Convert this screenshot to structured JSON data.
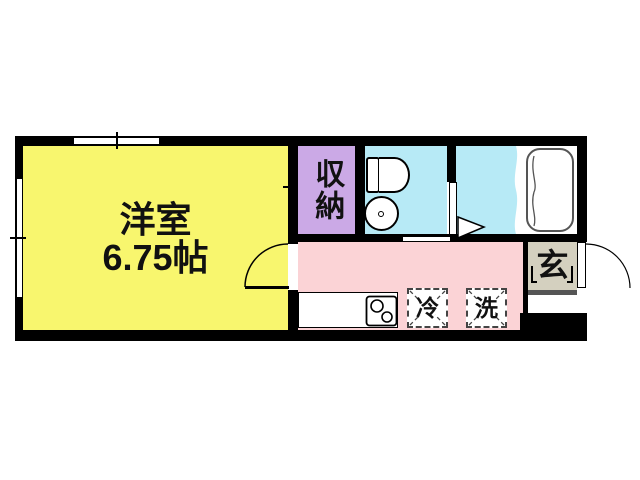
{
  "meta": {
    "type": "apartment-floor-plan"
  },
  "palette": {
    "wall": "#000000",
    "western_room": "#f8f66e",
    "closet": "#cba9e6",
    "wet_area": "#b7eaf6",
    "corridor": "#fbd3d6",
    "entrance": "#d4d0bf",
    "fixture_outline": "#555555"
  },
  "labels": {
    "western_room_name": "洋室",
    "western_room_size": "6.75帖",
    "closet": "収納",
    "refrigerator": "冷",
    "washing_machine": "洗",
    "entrance": "玄"
  },
  "icons": [
    "window-icon",
    "door-swing-icon",
    "toilet-icon",
    "wash-basin-icon",
    "bathtub-icon",
    "folding-door-icon",
    "stove-icon",
    "kitchen-counter",
    "entrance-step"
  ]
}
